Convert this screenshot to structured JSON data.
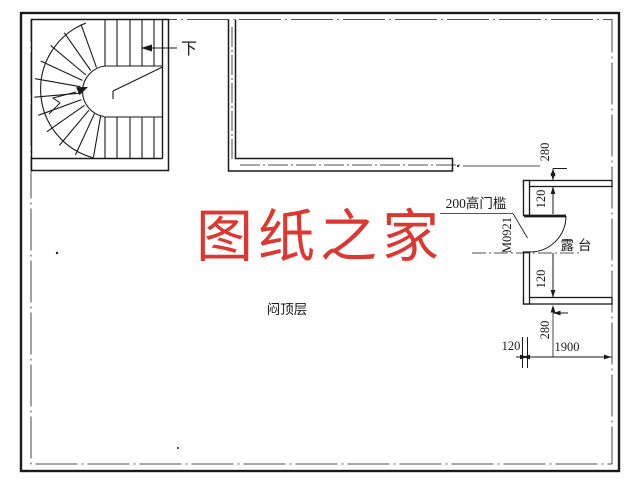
{
  "drawing": {
    "floor_label": "闷顶层",
    "watermark": {
      "text": "图纸之家",
      "color": "#dc3832"
    },
    "line_color": "#1a1a1a",
    "stair": {
      "direction_label": "下"
    },
    "terrace": {
      "room_label": "露台"
    },
    "door": {
      "tag": "M0921",
      "threshold_note": "200高门槛"
    },
    "dimensions": {
      "right_top_offset": "280",
      "terrace_wall_top": "120",
      "terrace_wall_bottom": "120",
      "right_bottom_offset": "280",
      "bottom_wall_thickness": "120",
      "terrace_width": "1900"
    }
  }
}
